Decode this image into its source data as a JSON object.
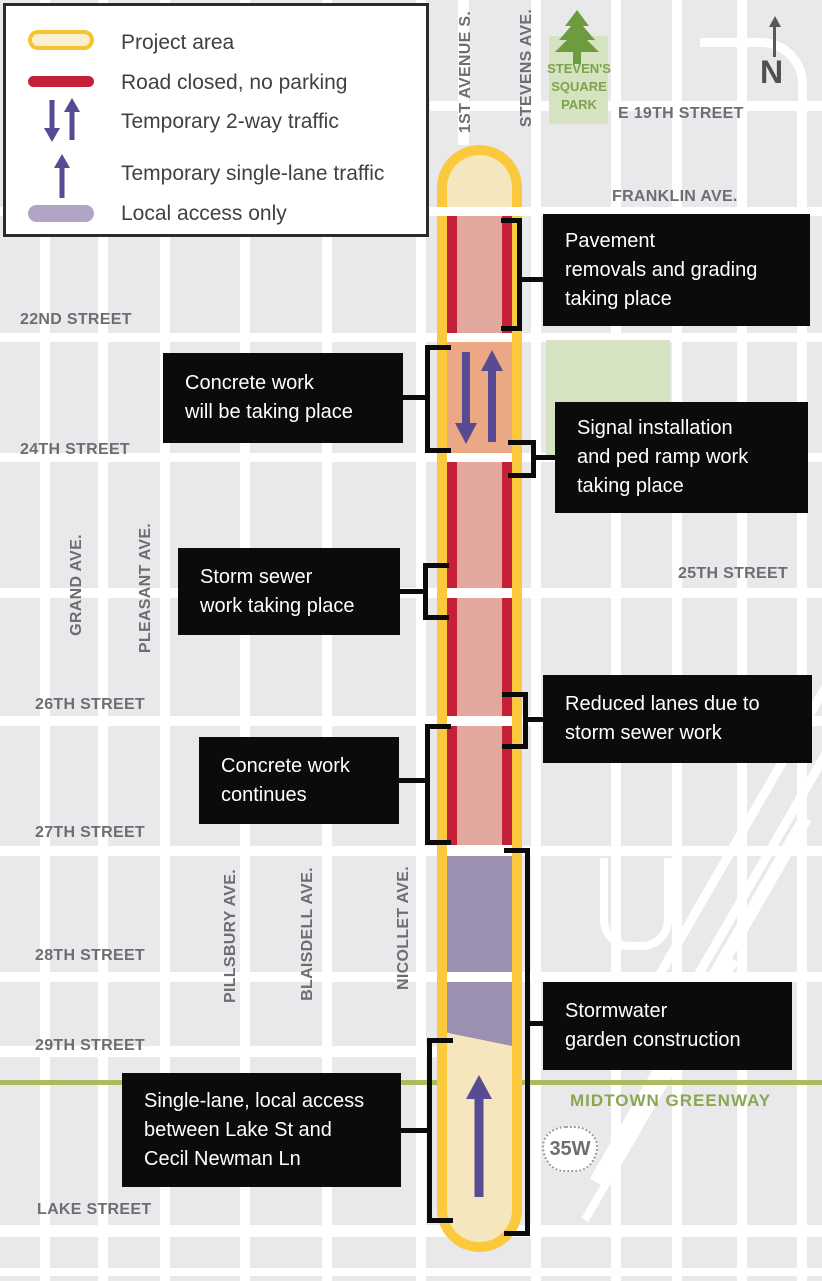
{
  "legend": {
    "items": [
      {
        "swatch": "project-area",
        "label": "Project area"
      },
      {
        "swatch": "road-closed",
        "label": "Road closed, no parking"
      },
      {
        "swatch": "two-way-arrows",
        "label": "Temporary 2-way traffic"
      },
      {
        "swatch": "single-lane-arrow",
        "label": "Temporary single-lane traffic"
      },
      {
        "swatch": "local-access",
        "label": "Local access only"
      }
    ]
  },
  "map": {
    "north_label": "N",
    "shield_label": "35W",
    "greenway_label": "MIDTOWN GREENWAY",
    "park_lines": [
      "STEVEN'S",
      "SQUARE",
      "PARK"
    ],
    "streets_h": [
      "E 19TH STREET",
      "FRANKLIN AVE.",
      "22ND STREET",
      "24TH STREET",
      "25TH STREET",
      "26TH STREET",
      "27TH STREET",
      "28TH STREET",
      "29TH STREET",
      "LAKE STREET"
    ],
    "streets_v": [
      "1ST AVENUE S.",
      "STEVENS AVE.",
      "GRAND AVE.",
      "PLEASANT AVE.",
      "PILLSBURY AVE.",
      "BLAISDELL AVE.",
      "NICOLLET AVE."
    ]
  },
  "callouts": [
    {
      "lines": [
        "Pavement",
        "removals and grading",
        "taking place"
      ]
    },
    {
      "lines": [
        "Concrete work",
        "will be taking place"
      ]
    },
    {
      "lines": [
        "Signal installation",
        "and ped ramp work",
        "taking place"
      ]
    },
    {
      "lines": [
        "Storm sewer",
        "work taking place"
      ]
    },
    {
      "lines": [
        "Reduced lanes due to",
        "storm sewer work"
      ]
    },
    {
      "lines": [
        "Concrete work",
        "continues"
      ]
    },
    {
      "lines": [
        "Stormwater",
        "garden construction"
      ]
    },
    {
      "lines": [
        "Single-lane, local access",
        "between Lake St and",
        "Cecil Newman Ln"
      ]
    }
  ],
  "colors": {
    "project_area_border": "#fbc93d",
    "project_area_fill": "#f5e6bd",
    "road_closed_red": "#c42138",
    "closed_fill_pink": "#e2a89d",
    "two_way_fill_orange": "#eaa884",
    "traffic_arrow_purple": "#584a93",
    "local_access_purple": "#9c90b1",
    "park_green": "#d6e3c0",
    "park_text_green": "#7fa24e",
    "greenway_olive": "#a9bc5e",
    "callout_bg": "#0b0b0b",
    "street_label_gray": "#6d6e71"
  }
}
